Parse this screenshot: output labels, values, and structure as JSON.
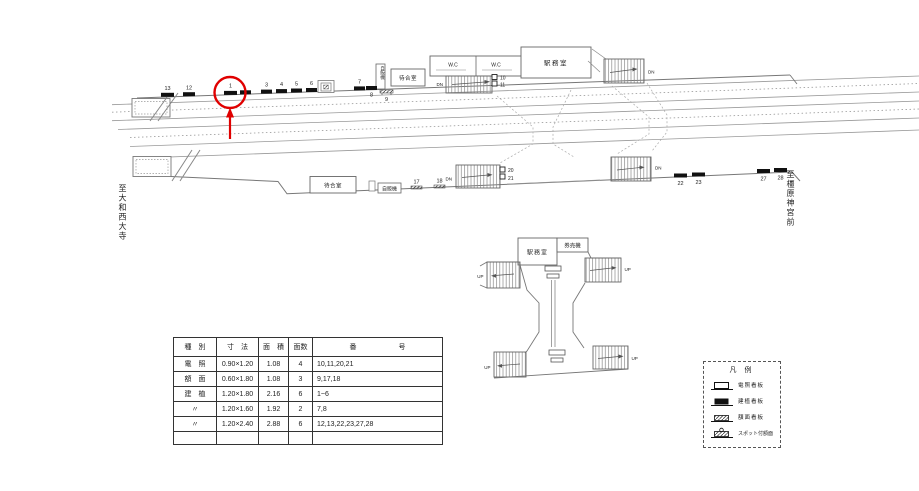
{
  "station": {
    "to_left": "至大和西大寺",
    "to_right": "至橿原神宮前"
  },
  "upper_platform": {
    "vending_machine_vertical": "自販機",
    "waiting_room": "待合室",
    "wc_left": "W.C",
    "wc_right": "W.C",
    "station_office": "駅務室",
    "stair_down_mid": "DN",
    "stair_down_right": "DN",
    "boards": {
      "n13": "13",
      "n12": "12",
      "n1": "1",
      "n3": "3",
      "n4": "4",
      "n5": "5",
      "n6": "6",
      "n7": "7",
      "n8": "8",
      "n9": "9",
      "n10": "10",
      "n11": "11"
    }
  },
  "lower_platform": {
    "waiting_room": "待合室",
    "vending_machine": "自販機",
    "stair_down_left": "DN",
    "stair_down_right": "DN",
    "boards": {
      "n17": "17",
      "n18": "18",
      "n20": "20",
      "n21": "21",
      "n22": "22",
      "n23": "23",
      "n27": "27",
      "n28": "28"
    }
  },
  "concourse": {
    "station_office": "駅務室",
    "ticket_machine": "券売機",
    "up_tl": "UP",
    "up_tr": "UP",
    "up_bl": "UP",
    "up_br": "UP"
  },
  "spec_table": {
    "headers": {
      "type": "種　別",
      "size": "寸　法",
      "area": "面　積",
      "faces": "面数",
      "numbers": "番　　　　　　号"
    },
    "rows": [
      {
        "type": "電　照",
        "size": "0.90×1.20",
        "area": "1.08",
        "faces": "4",
        "numbers": "10,11,20,21"
      },
      {
        "type": "額　面",
        "size": "0.60×1.80",
        "area": "1.08",
        "faces": "3",
        "numbers": "9,17,18"
      },
      {
        "type": "建　植",
        "size": "1.20×1.80",
        "area": "2.16",
        "faces": "6",
        "numbers": "1~6"
      },
      {
        "type": "〃",
        "size": "1.20×1.60",
        "area": "1.92",
        "faces": "2",
        "numbers": "7,8"
      },
      {
        "type": "〃",
        "size": "1.20×2.40",
        "area": "2.88",
        "faces": "6",
        "numbers": "12,13,22,23,27,28"
      },
      {
        "type": "",
        "size": "",
        "area": "",
        "faces": "",
        "numbers": ""
      }
    ]
  },
  "legend": {
    "title": "凡 例",
    "items": [
      {
        "icon": "lighted-signboard-icon",
        "label": "電照看板"
      },
      {
        "icon": "erected-signboard-icon",
        "label": "建植看板"
      },
      {
        "icon": "panel-signboard-icon",
        "label": "額面看板"
      },
      {
        "icon": "spot-panel-icon",
        "label": "スポット付額面"
      }
    ]
  },
  "annotation": {
    "highlighted_board": "1",
    "color": "#e00000"
  }
}
